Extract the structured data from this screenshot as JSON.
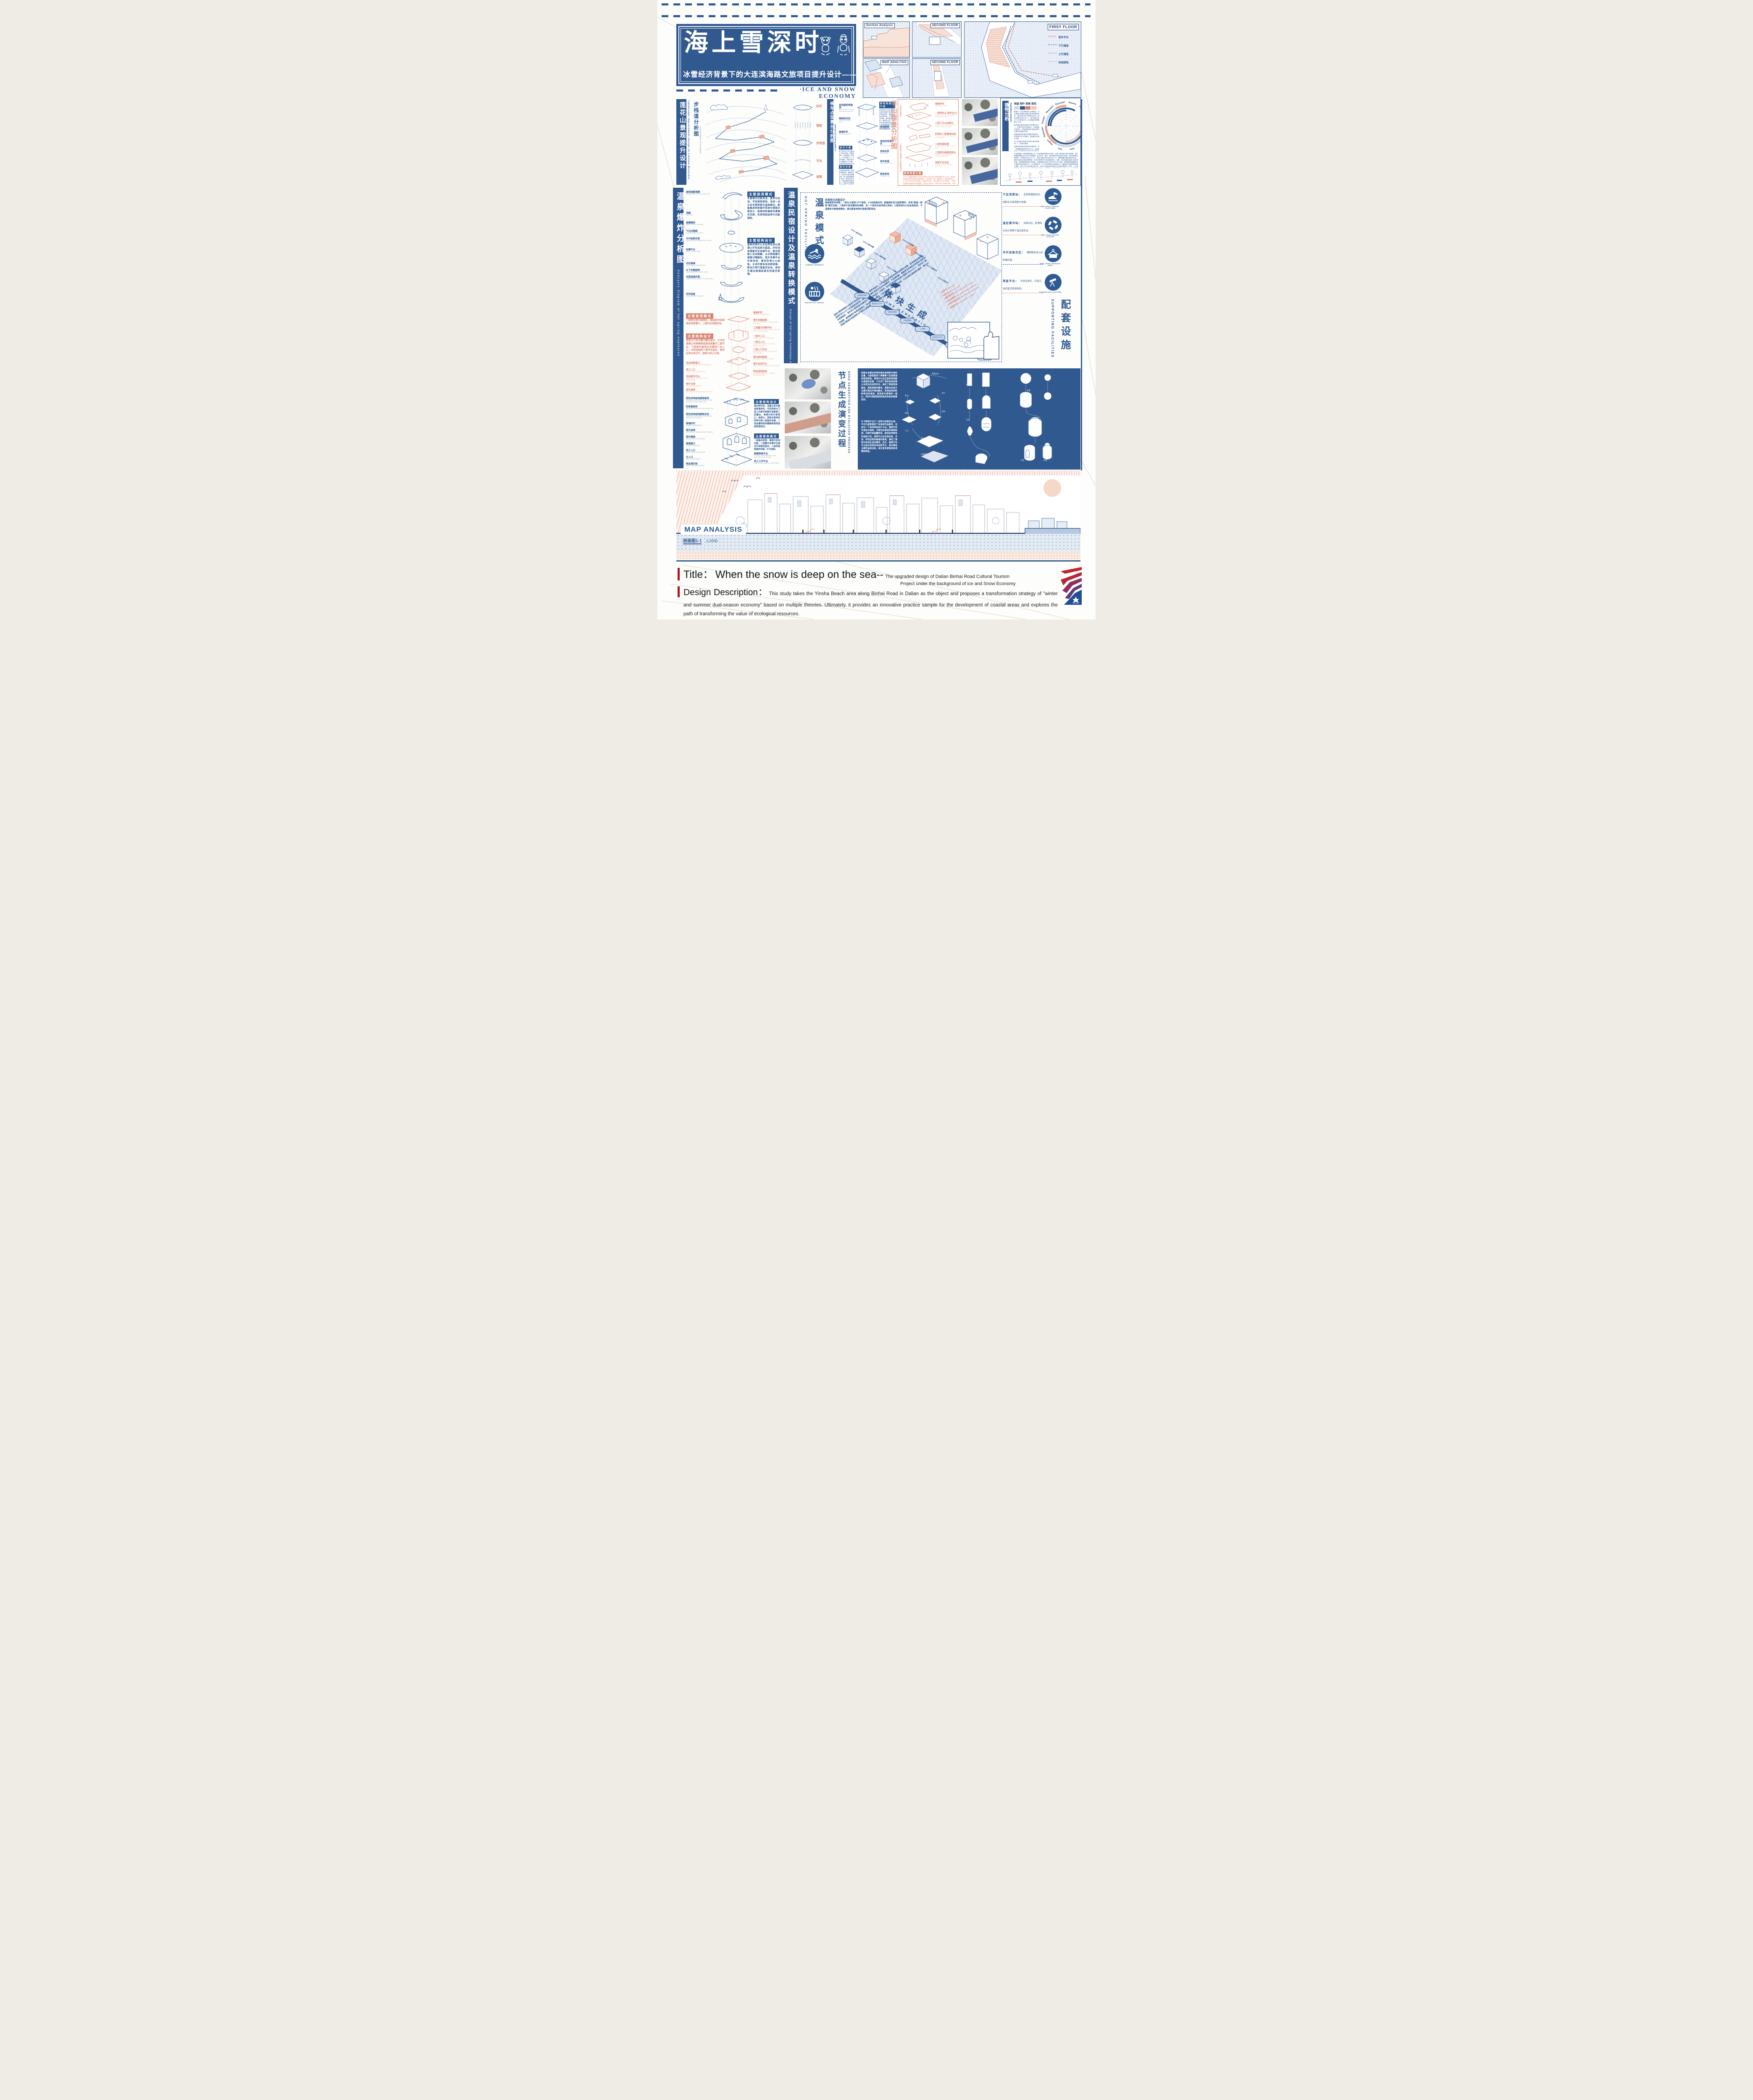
{
  "hdr": {
    "main": "海上雪深时",
    "sub": "冰雪经济背景下的大连滨海路文旅项目提升设计——",
    "eco": "·ICE AND SNOW ECONOMY"
  },
  "panels": {
    "sa": "Section Analysis",
    "sf1": "SECOND FLOOR",
    "ma": "MAP ANALYSIS",
    "sf2": "SECOND FLOOR",
    "ff": "FIRSY FLOOR",
    "leg": [
      "室外平台",
      "下行通道",
      "上行通道",
      "场地绿地"
    ]
  },
  "lh": {
    "cn": "莲花山景观提升设计",
    "en": "Landscape improvement design of Lianhua Mountain"
  },
  "fp": {
    "cn": "步栈道分析图",
    "en": "AnaLysis diagram of the footpath",
    "layers": [
      "栏杆",
      "钢架",
      "步栈道",
      "平台",
      "底图"
    ]
  },
  "wt": {
    "cn": "候车点观景台分析图",
    "en": "Waiting area viewing platform",
    "ll": [
      {
        "c": "休闲遮阳亭屋顶",
        "e": "Roof of the leisure sunshade pavilion"
      },
      {
        "c": "钢结构支柱",
        "e": "Steel structure pillar"
      },
      {
        "c": "玻璃护栏",
        "e": "Glass guardrail"
      }
    ],
    "lr": [
      {
        "c": "休闲座椅",
        "e": "Leisure seat"
      },
      {
        "c": "场地及栈道护栏",
        "e": "Guardrail system"
      },
      {
        "c": "场地台阶",
        "e": "Site steps"
      },
      {
        "c": "地块衔接",
        "e": "Plot connection"
      },
      {
        "c": "原始地块",
        "e": "Original site"
      }
    ],
    "h1": "使用场景介绍",
    "t1": "该场地设计改造主要为场地供游客作为景区中转驿站使用，兼具候车和休憩功能。不锈钢承担地基、梁架等承重结构，保障安全性，原木作为装饰覆盖外侧，减少直接接触恶劣环境，降低维护成本。材质碰撞形成视觉张力，如原木亭顶搭配不锈钢框架，展现“自然与现代对话”的美感。在自然景区，以木为主、金属隐于结构，保持原生态；在城市空间，金属为主体搭配原木装饰，平衡冷硬感。这种组合兼顾功能性、美学性与可持续性，适配不同场景需求。",
    "h2": "设计介绍",
    "t2": "整个候车点平台主要由以下部分组成：观景休闲亭、休闲座椅、候车点、下行栈道入口、平台阶梯等。该部分设计中主要解决以下问题：场地流线混乱和设计滞后。",
    "h3": "设计分析",
    "t3": "不锈钢承担地基、梁架等承重结构，保障安全性，原木作为装饰覆盖外侧，减少直接接触恶劣环境，降低维护成本。材质碰撞形成视觉张力，如原木亭顶搭配不锈钢框架，展现“自然与现代对话”的美感。在自然景区，以木为主、金属隐于结构，保持原生态；在城市空间，金属为主体搭配原木装饰，平衡冷硬感。"
  },
  "hm": {
    "cn": "半山观景分析图",
    "en": "Analysis diagram of the Half-Mountain View",
    "l": [
      {
        "c": "玻璃护栏",
        "e": "Glass guardrail"
      },
      {
        "c": "一层停车点 停车位×9",
        "e": "Parking and viewing point on the first floor"
      },
      {
        "c": "二层下沉山体部分",
        "e": "The sunken mountain part on the second floor"
      },
      {
        "c": "阶梯与二层墙体构成",
        "e": "The steps are composed of the walls"
      },
      {
        "c": "二层地面肌理",
        "e": "The texture of the second floor"
      },
      {
        "c": "二层室外悬挑观景台",
        "e": "Outdoor cantilevered viewing platform"
      },
      {
        "c": "观景平台支柱",
        "e": "Pillars of the viewing platform"
      }
    ],
    "s1": "一层停车观景点",
    "s2": "二层室内文创咖啡厅与悬挑观景台",
    "nh": "使用场景介绍",
    "nt": "对于半山腰处观景平台的设计借鉴之前的安吉茶室景馆的设计手法，希望在保留该处停车观景功能的基础上，通过嵌入的方法塑造出下沉的观景空间，扩大游人的活动空间范围。因此总结来说，该处观景平台共为两层，一层保留原有场地停车的功能属性，设有9个停车位，同时为防止车辆过多堆，采用阶梯下沉的形式为人群保留较少观景空间。"
  },
  "vg": {
    "cn": "植物分析",
    "en": "Vegetation analysis",
    "leg": [
      "观姿",
      "观叶",
      "观果",
      "观花"
    ],
    "months": [
      "January",
      "February",
      "March",
      "April",
      "May",
      "June",
      "July",
      "August",
      "September",
      "October",
      "November",
      "December"
    ],
    "ps": [
      "蔷薇在一年四季都是可以种植的，不过最佳的种植时间建议选择在春秋两季，春天和秋天的气候条件适中，温度温暖湿度也不大，春季播种后50~60天就能开花，秋季播种则需要等60~80天",
      "春季通常是侧柏最佳的种植时间之一，在寒冷的冬季结束后，土壤湿度开始回升，侧柏能够更好地适应新的环境并迅速建立根系",
      "紫藤的最佳种植时间是春季和秋季。特别是3月至4月期间，是紫藤的主要生长期",
      "玉兰的最佳种植时间是在春季或秋季，3、4月最为理想",
      "迎春连翘的最佳种植时间是秋季。这一时期通常指的是9月至10月，这段时间被认为是播种迎春花种子的最佳时期。",
      "玫瑰月季最佳种植时期在春季，通常从3月底到4月初开始。"
    ],
    "bt": "大连滨海路一带的植物景观以人工与自然植被的融合为特色，形成了独特的山海生态廊道。该区域植物群落包含41科共96种植物，其中乔木、灌木、草本及藤本构成多层次结构，但本地树种比例较低，外来树种占比达74.7%，常绿与落叶树种比例约为1:10。植物配置注重季相色彩变化，通过色系组合强化视觉韵律，形成“步移景异”的动态景观序列。然而，该区域面临盐碱土壤渗透压高、海风盐雾侵蚀等生态挑战，导致植被易出现“生理干旱”及叶片枯黄，需依赖耐盐碱植物及土壤改良技术维持生长。公众调研显示，63.2%的游客对自然地貌与人工植物结合的景观美感表示满意，但82.3%认为草花应用不足，且45.6%指出休息设施与文化展示牌缺失；同时，人工景型植物过度应用与自然山体植被融合欠佳成为主要短板。未来需增加本地树种比例，优化草本层次多样性，并植入海洋文化元素设施以提升生态韧性与文化认同。"
  },
  "ex": {
    "cn": "温泉爆炸分析图",
    "en": "AnaLysis diagram of hot spring explosion",
    "rl": [
      {
        "c": "遮阳格栅顶棚",
        "e": "SUNSHADE GRILLE CEILING"
      },
      {
        "c": "顶棚",
        "e": "CEILING"
      },
      {
        "c": "格栅围挡",
        "e": "GRILLE ENCLOSURE"
      },
      {
        "c": "下沉式围椅",
        "e": "SUNKEN ARMCHAIR"
      },
      {
        "c": "半开放更衣室",
        "e": "SEMI-OPEN CHANGING ROOM"
      },
      {
        "c": "休憩平台",
        "e": "REST PLATFORM"
      },
      {
        "c": "环形楼梯",
        "e": "CIRCULAR STAIRCASE"
      },
      {
        "c": "水下休憩座椅",
        "e": "UNDERWATER REST SEAT"
      },
      {
        "c": "夹胶玻璃外壁",
        "e": "LAMINATED GLASS OUTER WALL"
      },
      {
        "c": "环形底座",
        "e": "RING-SHAPED BASE"
      }
    ],
    "buh": "主要使用模式",
    "but": "冬夏模式切换灵活，夏季为泳池，可供游客使用，池深一点五米冬季转换为温泉模式，配备集成地热循环系统与镜面水景设计，耐候材料确保冬夏模式切换，实现视觉延伸与功能韧性。",
    "bsh": "主要结构设计",
    "bst": "温泉民宿中心无边界泳池以混凝土环形底座为基底，环形池体搭配环形休憩平台，更衣室嵌入泳池侧翼，以木质格栅与绿植分隔隐私，室外休憩平台环绕池体，铺设防滑火山岩板，水池外壁采用夹胶玻璃，配合灯带打造星空泳池，夜间可通过玻璃底面反射星空影像。",
    "puh": "主要使用模式",
    "put": "一层室内室外咖啡区，配备制作间和商品自取窗口，二层均为休憩空间。",
    "psh": "主要结构设计",
    "pst": "错层立方体与露天露台组合，正中的混凝土材质楼梯直接连接露天二层平台，下层室内咖啡区设置两个出入口，分别连接两个室外饮品区，制作区和主体分开，游客与员工分流。",
    "cl": [
      {
        "c": "饮品领取窗口",
        "e": "DRINK COLLECTION WINDOW"
      },
      {
        "c": "员工入口",
        "e": "EMPLOYEE ENTRANCE"
      },
      {
        "c": "饮品制作平台",
        "e": "BEVERAGE PRODUCTION PLATFORM"
      },
      {
        "c": "室外长椅",
        "e": "OUTDOOR BENCH"
      },
      {
        "c": "室外桌椅",
        "e": "OUTDOOR TABLES AND CHAIRS"
      }
    ],
    "cr": [
      {
        "c": "玻璃护栏",
        "e": "GLASS GUARDRAIL"
      },
      {
        "c": "室外休憩桌椅",
        "e": "OUTDOOR REST TABLES AND CHAIRS"
      },
      {
        "c": "二层露天休憩平台",
        "e": "THE SECOND FLOOR OPEN-AIR REST PLATFORM"
      },
      {
        "c": "一层次入口",
        "e": "FIRST-LEVEL ENTRANCE"
      },
      {
        "c": "一层主入口",
        "e": "MAIN ENTRANCE ON THE FIRST FLOOR"
      },
      {
        "c": "二层入口平台",
        "e": "SECOND-FLOOR ENTRANCE PLATFORM"
      },
      {
        "c": "室内曲线座椅",
        "e": "INDOOR CURVED SEATS"
      },
      {
        "c": "室外休闲平台",
        "e": "OUTDOOR LEISURE PLATFORM"
      },
      {
        "c": "特色造型装饰",
        "e": "CHARACTERISTIC SHAPE DECORATION"
      }
    ],
    "tl": [
      {
        "c": "特色拱券结构廊架装饰",
        "e": "SPECIAL ARCHED STRUCTURE PERGOLA DECORATION"
      },
      {
        "c": "拱券窗装饰",
        "e": "ARCHED WINDOW DECORATION"
      },
      {
        "c": "特色拱券结构廊架支柱",
        "e": "SPECIAL ARCHED STRUCTURE PERGOLA PILLARS"
      },
      {
        "c": "玻璃护栏",
        "e": "GLASS GUARDRAIL"
      },
      {
        "c": "室外桌椅",
        "e": "OUTDOOR TABLES AND CHAIRS"
      },
      {
        "c": "室外楼梯",
        "e": "OUTDOOR STAIRCASE"
      },
      {
        "c": "售票窗口",
        "e": "TICKET WINDOW"
      },
      {
        "c": "员工入口",
        "e": "EMPLOYEE ENTRANCE"
      },
      {
        "c": "主入口",
        "e": "MAIN ENTRANCE"
      },
      {
        "c": "物品储存架",
        "e": "ITEM STORAGE RACK"
      }
    ],
    "tr": [
      {
        "c": "购票等候平台",
        "e": "TICKET PURCHASING AND WAITING PLATFORM"
      },
      {
        "c": "员工工作平台",
        "e": "EMPLOYEE WORK PLATFORM"
      }
    ],
    "tsh": "主要结构设计",
    "tst": "轴对称布局，混凝土体块高迪错落排布，中间拱券大门进入内部可两侧分流直通二层露台，两侧分别为售票口、检票口，游客在等待时同伴可到二层临时休憩，二层设置特色拱圈廊架装饰连接贯通空间。",
    "tuh": "主要使用模式",
    "tut": "一层融合售票、储物与咨询功能，二层露天休憩平台通过外双路径直达，二层供游客临时休憩、打卡拍照。"
  },
  "hs": {
    "cn": "温泉民宿设计及温泉转换模式",
    "en": "Design of hot spring homestays and hot spring conversion models",
    "fac": "HOT SPRING FACILITIES",
    "mode": "温泉模式",
    "uh": "民宿单元功能设计",
    "ut": "每栋建筑共四层，一层为大堂和LOFT客房，5.4米挑高空间，配备娱乐区与投影幕布，实现“居室—影院”模式切换；二层亲子房设置特色滑梯，另一个房间为标间或大床房；三层洗浴中心包含淋浴间、干湿蒸房与智能按摩池，通过垂直电梯可直通顶层泡池。",
    "vc": "体块生成",
    "ve": "VOLUME GENERATION",
    "steps": [
      "STEP1:基本体块",
      "STEP2:竖向体量",
      "STEP3:横向体量",
      "STEP4:下沉露台",
      "STEP5:空间连通",
      "STEP6:楼梯连通",
      "STEP7:体量组合",
      "STEP8:开窗开门"
    ],
    "sumtxt": "SUMMER SWIMMING",
    "wintxt": "WINTER HOT SPRING",
    "conv": "温泉冬夏转换模式以季节为导向实现功能切换：夏季来临时，工作人员先对温泉池进行全面清洁消毒，启动降温设备将水温调节至24-28℃适宜游泳的区间，同时切换水循环系统为泳池专用模式，开启遮阳棚，整备救生设施后开放游泳功能；冬季降临时，首先停止游泳相关设备运行，对池体进行二次清洁，启动恒温加热系统将水温提升至30-35℃，同步注入富含硫磺、偏硅酸等矿物质的温泉水，经水质检测达标后，关闭遮阳棚，增设保暖设施，正式切换为温泉养生模式，整个过程通过精准的设备调控与严格的水质管理确保两种模式安全顺畅转换。",
    "flow": [
      "全面清洁消毒",
      "降温至24-28℃",
      "切换泳池模式",
      "开启遮阳棚",
      "二次清洁",
      "加热至30-35℃",
      "注入矿物温泉水",
      "水质检测达标",
      "开启温泉(含保暖设备)"
    ],
    "nleg": [
      {
        "n": "①",
        "c": "深水池",
        "e": "DEEP POOL"
      },
      {
        "n": "②",
        "c": "浅水池",
        "e": "SHALLOW POOL"
      },
      {
        "n": "③",
        "c": "湿区缓冲站",
        "e": "WET ZONE BUFFER STATION"
      },
      {
        "n": "④",
        "c": "干区观景台",
        "e": "DRY AREA VIEWING PLATFORM"
      },
      {
        "n": "⑤",
        "c": "半开放换衣区",
        "e": "SEMI-OPEN CHANGING AREA"
      },
      {
        "n": "⑥",
        "c": "观星平台",
        "e": "STARGAZING PLATFORM"
      }
    ]
  },
  "sp": {
    "cn": "配套设施",
    "en": "SUPPORTING FACILITIES",
    "items": [
      {
        "l": "干区观景站：",
        "d": "全视角通透空间，适配全天候观景与休憩。",
        "r": "DRY AREA VIEWING PLATFORM"
      },
      {
        "l": "湿区缓冲站：",
        "d": "衔接水区，防滑吸水设计保障干湿过渡安全。",
        "r": "WET ZONE BUFFER STATION"
      },
      {
        "l": "半开放换衣区：",
        "d": "兼顾隐私性与自然通风感。",
        "r": "SEMI-OPEN CHANGING AREA"
      },
      {
        "l": "观星平台：",
        "d": "开阔无遮栏，打造沉浸式星空观测体验。",
        "r": "STARGAZING PLATFORM"
      }
    ]
  },
  "ne": {
    "cn": "节点生成演变过程",
    "en": "NODE GENERATION AND EVOLUTION PROCESS",
    "p1": "观景台设置在场地的高处或视野开阔的位置，为游客提供了俯瞰整个区域景观的绝佳视角。游客可以在这里欣赏到跌水景观的全貌、下沉式广场的活动场景以及周边的自然风光，满足了游客登高望远、观赏美景的需求。观景台的设计注重与周边环境的融合，采用自然材料和简洁的造型，使其成为景观的一部分，同时为游客提供舒适的休息和观景空间。",
    "p2": "打卡咖啡厅位于人流较为密集的区域，不仅为游客提供了休息和饮品服务，还成为一个具有特色的打卡点。咖啡厅的外观设计独特，与周边的景观风格相协调，内部环境温馨舒适，提供各种特色饮品和小吃。游客可以在这里休息、交流，同时欣赏到美丽的景观，满足了游客对休闲生活的需求。此外，咖啡厅还可以结合场地的活动和节日，推出特色主题饮品和活动，吸引更多游客前来消费和体验。",
    "steps": [
      "基础体块",
      "划分",
      "移除",
      "拆分",
      "变形",
      "组装",
      "旋转组装",
      "联合拼装",
      "悬挑平台基座",
      "空间结构连接件",
      "管道、楼梯连接",
      "场景模拟",
      "细化",
      "连接",
      "开洞",
      "旋转楼梯",
      "格栅观景台",
      "布置",
      "外层",
      "内层",
      "下沉"
    ]
  },
  "sb": {
    "label": "MAP ANALYSIS",
    "name": "剖面图1-1",
    "scale": "1:2000"
  },
  "ft": {
    "tl": "Title：",
    "tm": "When the snow is deep on the sea--",
    "ts1": "The upgraded design of Dalian Binhai Road Cultural Tourism",
    "ts2": "Project under the background of ice and Snow Economy",
    "dl": "Design Description：",
    "dt": "This study takes the Yinsha Beach area along Binhai Road in Dalian as the object and proposes a transformation strategy of \"winter and summer dual-season economy\" based on multiple theories. Ultimately, it provides an innovative practice sample for the development of coastal areas and explores the path of transforming the value of ecological resources."
  }
}
